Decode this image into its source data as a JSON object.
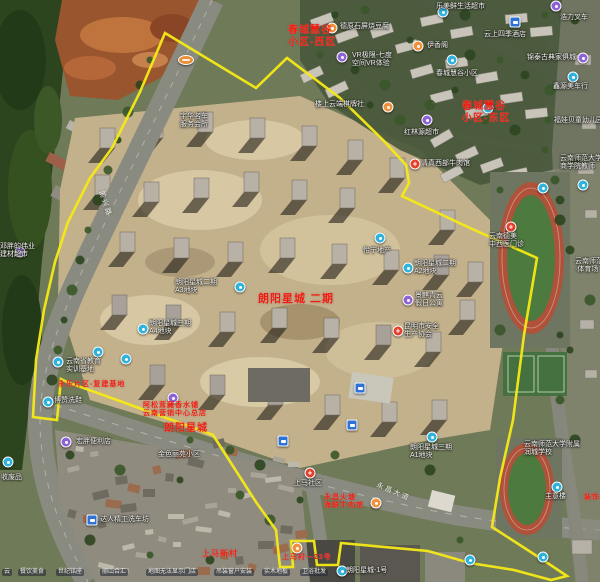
{
  "map": {
    "boundary": {
      "color": "#f6ea16",
      "points": [
        [
          165,
          33
        ],
        [
          256,
          88
        ],
        [
          287,
          58
        ],
        [
          340,
          98
        ],
        [
          383,
          140
        ],
        [
          406,
          165
        ],
        [
          409,
          183
        ],
        [
          402,
          196
        ],
        [
          470,
          228
        ],
        [
          537,
          258
        ],
        [
          524,
          335
        ],
        [
          513,
          420
        ],
        [
          500,
          478
        ],
        [
          492,
          527
        ],
        [
          543,
          560
        ],
        [
          567,
          576
        ],
        [
          551,
          580
        ],
        [
          514,
          570
        ],
        [
          470,
          563
        ],
        [
          428,
          551
        ],
        [
          341,
          543
        ],
        [
          338,
          565
        ],
        [
          317,
          565
        ],
        [
          314,
          541
        ],
        [
          291,
          541
        ],
        [
          293,
          567
        ],
        [
          280,
          567
        ],
        [
          276,
          530
        ],
        [
          256,
          502
        ],
        [
          213,
          435
        ],
        [
          150,
          412
        ],
        [
          67,
          382
        ],
        [
          61,
          379
        ],
        [
          57,
          420
        ],
        [
          33,
          417
        ],
        [
          36,
          360
        ],
        [
          44,
          310
        ],
        [
          55,
          262
        ],
        [
          68,
          222
        ],
        [
          90,
          178
        ],
        [
          112,
          148
        ],
        [
          140,
          92
        ]
      ]
    },
    "area_labels": [
      {
        "x": 288,
        "y": 25,
        "size": 10,
        "lines": [
          "春城慧谷",
          "小区-西区"
        ]
      },
      {
        "x": 462,
        "y": 101,
        "size": 10,
        "lines": [
          "春城慧谷",
          "小区-东区"
        ]
      },
      {
        "x": 258,
        "y": 293,
        "size": 11,
        "lines": [
          "朗阳星城 二期"
        ]
      },
      {
        "x": 164,
        "y": 423,
        "size": 10,
        "lines": [
          "朗阳星城"
        ]
      },
      {
        "x": 143,
        "y": 402,
        "size": 7,
        "lines": [
          "阿松茸藏香水铺",
          "云南营销中心总店"
        ]
      },
      {
        "x": 58,
        "y": 381,
        "size": 7,
        "lines": [
          "永乐片区-复建基地"
        ]
      },
      {
        "x": 324,
        "y": 494,
        "size": 7,
        "lines": [
          "永昌火塘",
          "海鲜牛肉馆"
        ]
      },
      {
        "x": 202,
        "y": 549,
        "size": 8,
        "lines": [
          "上马新村"
        ]
      },
      {
        "x": 282,
        "y": 554,
        "size": 7,
        "lines": [
          "上马村—23号"
        ]
      },
      {
        "x": 584,
        "y": 494,
        "size": 7,
        "lines": [
          "装饰"
        ]
      }
    ],
    "poi_labels": [
      {
        "x": 436,
        "y": 3,
        "lines": [
          "乐美鲜生活超市"
        ]
      },
      {
        "x": 560,
        "y": 14,
        "lines": [
          "浩力叉车"
        ]
      },
      {
        "x": 340,
        "y": 23,
        "lines": [
          "德原石屏烧豆腐"
        ]
      },
      {
        "x": 484,
        "y": 31,
        "lines": [
          "云上四季酒店"
        ]
      },
      {
        "x": 427,
        "y": 42,
        "lines": [
          "伊香阁"
        ]
      },
      {
        "x": 527,
        "y": 54,
        "lines": [
          "锦泰古典家俱城"
        ]
      },
      {
        "x": 352,
        "y": 52,
        "lines": [
          "VR极限-七度",
          "空间VR体验"
        ]
      },
      {
        "x": 436,
        "y": 70,
        "lines": [
          "春城慧谷小区"
        ]
      },
      {
        "x": 553,
        "y": 83,
        "lines": [
          "鑫源美车行"
        ]
      },
      {
        "x": 315,
        "y": 101,
        "lines": [
          "楼上云端棋牌社"
        ]
      },
      {
        "x": 554,
        "y": 117,
        "lines": [
          "福娃贝童幼儿园"
        ]
      },
      {
        "x": 404,
        "y": 129,
        "lines": [
          "红林源超市"
        ]
      },
      {
        "x": 180,
        "y": 113,
        "lines": [
          "宇华名车",
          "服务会所"
        ]
      },
      {
        "x": 421,
        "y": 160,
        "lines": [
          "清真西部牛肉馆"
        ]
      },
      {
        "x": 560,
        "y": 155,
        "lines": [
          "云南师范大学",
          "商学院教师"
        ]
      },
      {
        "x": 489,
        "y": 233,
        "lines": [
          "云南德美",
          "中西医门诊"
        ]
      },
      {
        "x": 363,
        "y": 247,
        "lines": [
          "怡宁地产"
        ]
      },
      {
        "x": 414,
        "y": 260,
        "lines": [
          "朗阳星城二期",
          "A2地块"
        ]
      },
      {
        "x": 175,
        "y": 279,
        "lines": [
          "朗阳星城二期",
          "A3地块"
        ]
      },
      {
        "x": 415,
        "y": 292,
        "lines": [
          "景麒青云",
          "假日公寓"
        ]
      },
      {
        "x": 404,
        "y": 323,
        "lines": [
          "昆明市安全",
          "生产协会"
        ]
      },
      {
        "x": 149,
        "y": 320,
        "lines": [
          "朗阳星城三期",
          "A4地块"
        ]
      },
      {
        "x": 66,
        "y": 358,
        "lines": [
          "云南省教育",
          "实训基地"
        ]
      },
      {
        "x": 54,
        "y": 397,
        "lines": [
          "博赞洗鞋"
        ]
      },
      {
        "x": 76,
        "y": 438,
        "lines": [
          "宏胖便利店"
        ]
      },
      {
        "x": 1,
        "y": 474,
        "lines": [
          "收废品"
        ]
      },
      {
        "x": 158,
        "y": 451,
        "lines": [
          "金色丽苑小区"
        ]
      },
      {
        "x": 100,
        "y": 516,
        "lines": [
          "达人精工洗车坊"
        ]
      },
      {
        "x": 294,
        "y": 480,
        "lines": [
          "上马社区"
        ]
      },
      {
        "x": 410,
        "y": 444,
        "lines": [
          "朗阳星城三期",
          "A1地块"
        ]
      },
      {
        "x": 524,
        "y": 441,
        "lines": [
          "云南师范大学附属",
          "润城学校"
        ]
      },
      {
        "x": 545,
        "y": 493,
        "lines": [
          "主意楼"
        ]
      },
      {
        "x": 575,
        "y": 258,
        "lines": [
          "云南师范",
          "·体育场"
        ]
      },
      {
        "x": 346,
        "y": 567,
        "lines": [
          "朗阳星城-1号"
        ]
      },
      {
        "x": 0,
        "y": 243,
        "lines": [
          "邓胖的伟业",
          "建材超市"
        ]
      }
    ],
    "road_labels": [
      {
        "x": 104,
        "y": 190,
        "rot": 72,
        "text": "前兴路"
      },
      {
        "x": 378,
        "y": 482,
        "rot": 23,
        "text": "永昌大道"
      }
    ],
    "strip_labels": [
      {
        "x": 2,
        "text": "云"
      },
      {
        "x": 18,
        "text": "餐饮美食"
      },
      {
        "x": 56,
        "text": "世纪铭座"
      },
      {
        "x": 100,
        "text": "丽山合汇"
      },
      {
        "x": 146,
        "text": "地图无法显示门店"
      },
      {
        "x": 214,
        "text": "吊装窗户安装"
      },
      {
        "x": 262,
        "text": "实木地板"
      },
      {
        "x": 300,
        "text": "卫浴批发"
      }
    ],
    "markers": [
      {
        "x": 443,
        "y": 12,
        "t": "teal"
      },
      {
        "x": 452,
        "y": 60,
        "t": "teal"
      },
      {
        "x": 573,
        "y": 77,
        "t": "teal"
      },
      {
        "x": 488,
        "y": 108,
        "t": "teal"
      },
      {
        "x": 543,
        "y": 188,
        "t": "teal"
      },
      {
        "x": 583,
        "y": 185,
        "t": "teal"
      },
      {
        "x": 380,
        "y": 238,
        "t": "teal"
      },
      {
        "x": 408,
        "y": 268,
        "t": "teal"
      },
      {
        "x": 240,
        "y": 287,
        "t": "teal"
      },
      {
        "x": 143,
        "y": 329,
        "t": "teal"
      },
      {
        "x": 98,
        "y": 352,
        "t": "teal"
      },
      {
        "x": 126,
        "y": 359,
        "t": "teal"
      },
      {
        "x": 58,
        "y": 362,
        "t": "teal"
      },
      {
        "x": 48,
        "y": 402,
        "t": "teal"
      },
      {
        "x": 8,
        "y": 462,
        "t": "teal"
      },
      {
        "x": 432,
        "y": 437,
        "t": "teal"
      },
      {
        "x": 470,
        "y": 560,
        "t": "teal"
      },
      {
        "x": 543,
        "y": 557,
        "t": "teal"
      },
      {
        "x": 557,
        "y": 487,
        "t": "teal"
      },
      {
        "x": 342,
        "y": 571,
        "t": "teal"
      },
      {
        "x": 20,
        "y": 252,
        "t": "purple"
      },
      {
        "x": 342,
        "y": 57,
        "t": "purple"
      },
      {
        "x": 427,
        "y": 120,
        "t": "purple"
      },
      {
        "x": 66,
        "y": 442,
        "t": "purple"
      },
      {
        "x": 173,
        "y": 398,
        "t": "purple"
      },
      {
        "x": 408,
        "y": 300,
        "t": "purple"
      },
      {
        "x": 583,
        "y": 58,
        "t": "purple"
      },
      {
        "x": 556,
        "y": 6,
        "t": "purple"
      },
      {
        "x": 332,
        "y": 28,
        "t": "orange"
      },
      {
        "x": 418,
        "y": 46,
        "t": "orange"
      },
      {
        "x": 388,
        "y": 107,
        "t": "orange"
      },
      {
        "x": 297,
        "y": 548,
        "t": "orange"
      },
      {
        "x": 376,
        "y": 503,
        "t": "orange"
      },
      {
        "x": 415,
        "y": 164,
        "t": "red"
      },
      {
        "x": 511,
        "y": 227,
        "t": "red"
      },
      {
        "x": 398,
        "y": 331,
        "t": "red"
      },
      {
        "x": 310,
        "y": 473,
        "t": "red"
      },
      {
        "x": 283,
        "y": 441,
        "t": "bus"
      },
      {
        "x": 360,
        "y": 388,
        "t": "bus"
      },
      {
        "x": 352,
        "y": 425,
        "t": "bus"
      },
      {
        "x": 92,
        "y": 520,
        "t": "bus"
      },
      {
        "x": 515,
        "y": 22,
        "t": "bus"
      },
      {
        "x": 186,
        "y": 60,
        "t": "shield"
      }
    ]
  }
}
